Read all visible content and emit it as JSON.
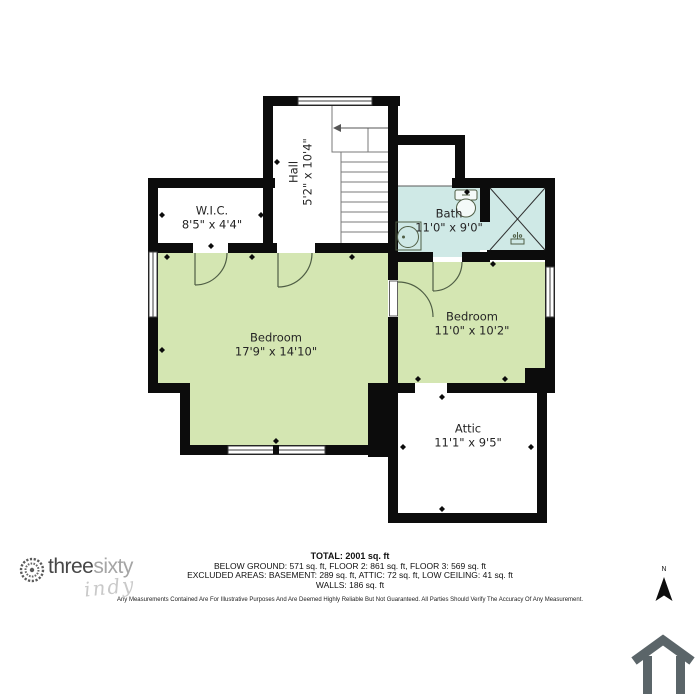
{
  "plan": {
    "rooms": [
      {
        "id": "wic",
        "name": "W.I.C.",
        "dims": "8'5\" x 4'4\""
      },
      {
        "id": "hall",
        "name": "Hall",
        "dims": "5'2\" x 10'4\""
      },
      {
        "id": "bath",
        "name": "Bath",
        "dims": "11'0\" x 9'0\""
      },
      {
        "id": "bedroom-1",
        "name": "Bedroom",
        "dims": "17'9\" x 14'10\""
      },
      {
        "id": "bedroom-2",
        "name": "Bedroom",
        "dims": "11'0\" x 10'2\""
      },
      {
        "id": "attic",
        "name": "Attic",
        "dims": "11'1\" x 9'5\""
      }
    ],
    "colors": {
      "wall": "#0c0c0c",
      "room_green": "#d4e6b2",
      "bath_blue": "#cfe9e6",
      "fixture_line": "#4f5e45",
      "house_icon_gray": "#5b6569"
    }
  },
  "footer": {
    "total": "TOTAL: 2001 sq. ft",
    "line2": "BELOW GROUND: 571 sq. ft, FLOOR 2: 861 sq. ft, FLOOR 3: 569 sq. ft",
    "line3": "EXCLUDED AREAS: BASEMENT: 289 sq. ft, ATTIC: 72 sq. ft, LOW CEILING: 41 sq. ft",
    "line4": "WALLS: 186 sq. ft",
    "disclaimer": "Any Measurements Contained Are For Illustrative Purposes And Are Deemed Highly Reliable But Not Guaranteed. All Parties Should Verify The Accuracy Of Any Measurement."
  },
  "logo": {
    "brand_part1": "three",
    "brand_part2": "sixty",
    "brand_script": "indy"
  },
  "compass": {
    "north_label": "N"
  }
}
